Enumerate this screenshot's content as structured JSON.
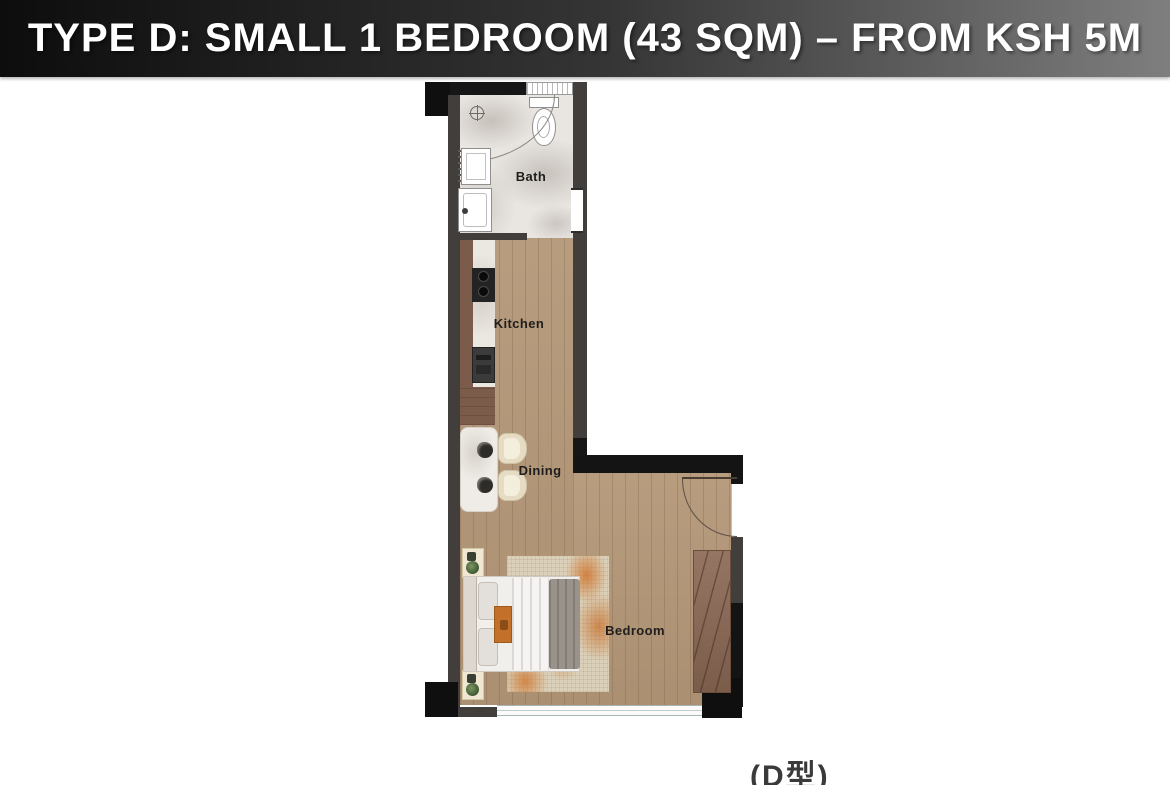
{
  "banner": {
    "title": "TYPE D: SMALL 1 BEDROOM (43 SQM) – FROM KSH 5M",
    "bg_gradient_left": "#0d0d0d",
    "bg_gradient_right": "#7e7e7e",
    "text_color": "#ffffff"
  },
  "floor_plan": {
    "rooms": {
      "bath": "Bath",
      "kitchen": "Kitchen",
      "dining": "Dining",
      "bedroom": "Bedroom"
    },
    "fixtures": [
      "toilet",
      "shower-drain",
      "shower-curtain",
      "bath-sink",
      "washing-machine",
      "stove",
      "oven",
      "kitchen-counter",
      "dining-table",
      "dining-chairs",
      "bed",
      "nightstands",
      "plants",
      "rug",
      "wardrobe",
      "entry-door",
      "windows"
    ],
    "colors": {
      "wall": "#413e3c",
      "column": "#0f0f0f",
      "wood_floor": "#b49778",
      "bath_marble": "#e9e6e2",
      "counter_wood": "#7b5b4a",
      "rug_accent": "#d0742c",
      "label_text": "#1f1e1d"
    }
  },
  "footer": {
    "unit_type_label": "(D型)"
  }
}
